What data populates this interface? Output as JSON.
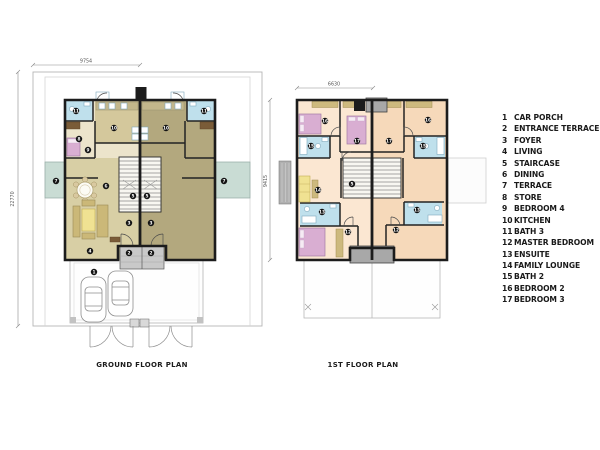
{
  "ground_floor": {
    "title": "GROUND FLOOR PLAN",
    "width_dim": "9754",
    "height_dim": "22770",
    "markers": [
      {
        "n": "11",
        "x": 76,
        "y": 111
      },
      {
        "n": "10",
        "x": 114,
        "y": 128
      },
      {
        "n": "8",
        "x": 79,
        "y": 139
      },
      {
        "n": "9",
        "x": 88,
        "y": 150
      },
      {
        "n": "6",
        "x": 106,
        "y": 186
      },
      {
        "n": "7",
        "x": 56,
        "y": 181
      },
      {
        "n": "5",
        "x": 133,
        "y": 196
      },
      {
        "n": "3",
        "x": 129,
        "y": 223
      },
      {
        "n": "4",
        "x": 90,
        "y": 251
      },
      {
        "n": "2",
        "x": 129,
        "y": 253
      },
      {
        "n": "1",
        "x": 94,
        "y": 272
      },
      {
        "n": "11",
        "x": 204,
        "y": 111
      },
      {
        "n": "10",
        "x": 166,
        "y": 128
      },
      {
        "n": "7",
        "x": 224,
        "y": 181
      },
      {
        "n": "5",
        "x": 147,
        "y": 196
      },
      {
        "n": "3",
        "x": 151,
        "y": 223
      },
      {
        "n": "2",
        "x": 151,
        "y": 253
      }
    ]
  },
  "first_floor": {
    "title": "1ST FLOOR PLAN",
    "width_dim": "6630",
    "height_dim": "9415",
    "markers": [
      {
        "n": "16",
        "x": 325,
        "y": 121
      },
      {
        "n": "17",
        "x": 357,
        "y": 141
      },
      {
        "n": "15",
        "x": 311,
        "y": 146
      },
      {
        "n": "14",
        "x": 318,
        "y": 190
      },
      {
        "n": "5",
        "x": 352,
        "y": 184
      },
      {
        "n": "13",
        "x": 322,
        "y": 212
      },
      {
        "n": "12",
        "x": 348,
        "y": 232
      },
      {
        "n": "16",
        "x": 428,
        "y": 120
      },
      {
        "n": "17",
        "x": 389,
        "y": 141
      },
      {
        "n": "15",
        "x": 423,
        "y": 146
      },
      {
        "n": "13",
        "x": 417,
        "y": 210
      },
      {
        "n": "12",
        "x": 396,
        "y": 230
      }
    ]
  },
  "legend": {
    "items": [
      {
        "num": "1",
        "label": "CAR PORCH"
      },
      {
        "num": "2",
        "label": "ENTRANCE TERRACE"
      },
      {
        "num": "3",
        "label": "FOYER"
      },
      {
        "num": "4",
        "label": "LIVING"
      },
      {
        "num": "5",
        "label": "STAIRCASE"
      },
      {
        "num": "6",
        "label": "DINING"
      },
      {
        "num": "7",
        "label": "TERRACE"
      },
      {
        "num": "8",
        "label": "STORE"
      },
      {
        "num": "9",
        "label": "BEDROOM 4"
      },
      {
        "num": "10",
        "label": "KITCHEN"
      },
      {
        "num": "11",
        "label": "BATH 3"
      },
      {
        "num": "12",
        "label": "MASTER BEDROOM"
      },
      {
        "num": "13",
        "label": "ENSUITE"
      },
      {
        "num": "14",
        "label": "FAMILY LOUNGE"
      },
      {
        "num": "15",
        "label": "BATH 2"
      },
      {
        "num": "16",
        "label": "BEDROOM 2"
      },
      {
        "num": "17",
        "label": "BEDROOM 3"
      }
    ]
  },
  "colors": {
    "wall": "#1c1c1c",
    "unit_left_floor": "#ece4cb",
    "unit_left_living": "#d8cfa5",
    "unit_right_floor": "#b3a87e",
    "kitchen": "#d4c89c",
    "bath": "#bfe0ec",
    "bed": "#d9aed2",
    "sofa_yellow": "#f0e292",
    "wood": "#cdb97e",
    "terrace_green": "#c9dcd4",
    "floor1_left": "#fbe7d2",
    "floor1_right": "#f6d9ba",
    "canopy_gray": "#a8a8a8"
  }
}
